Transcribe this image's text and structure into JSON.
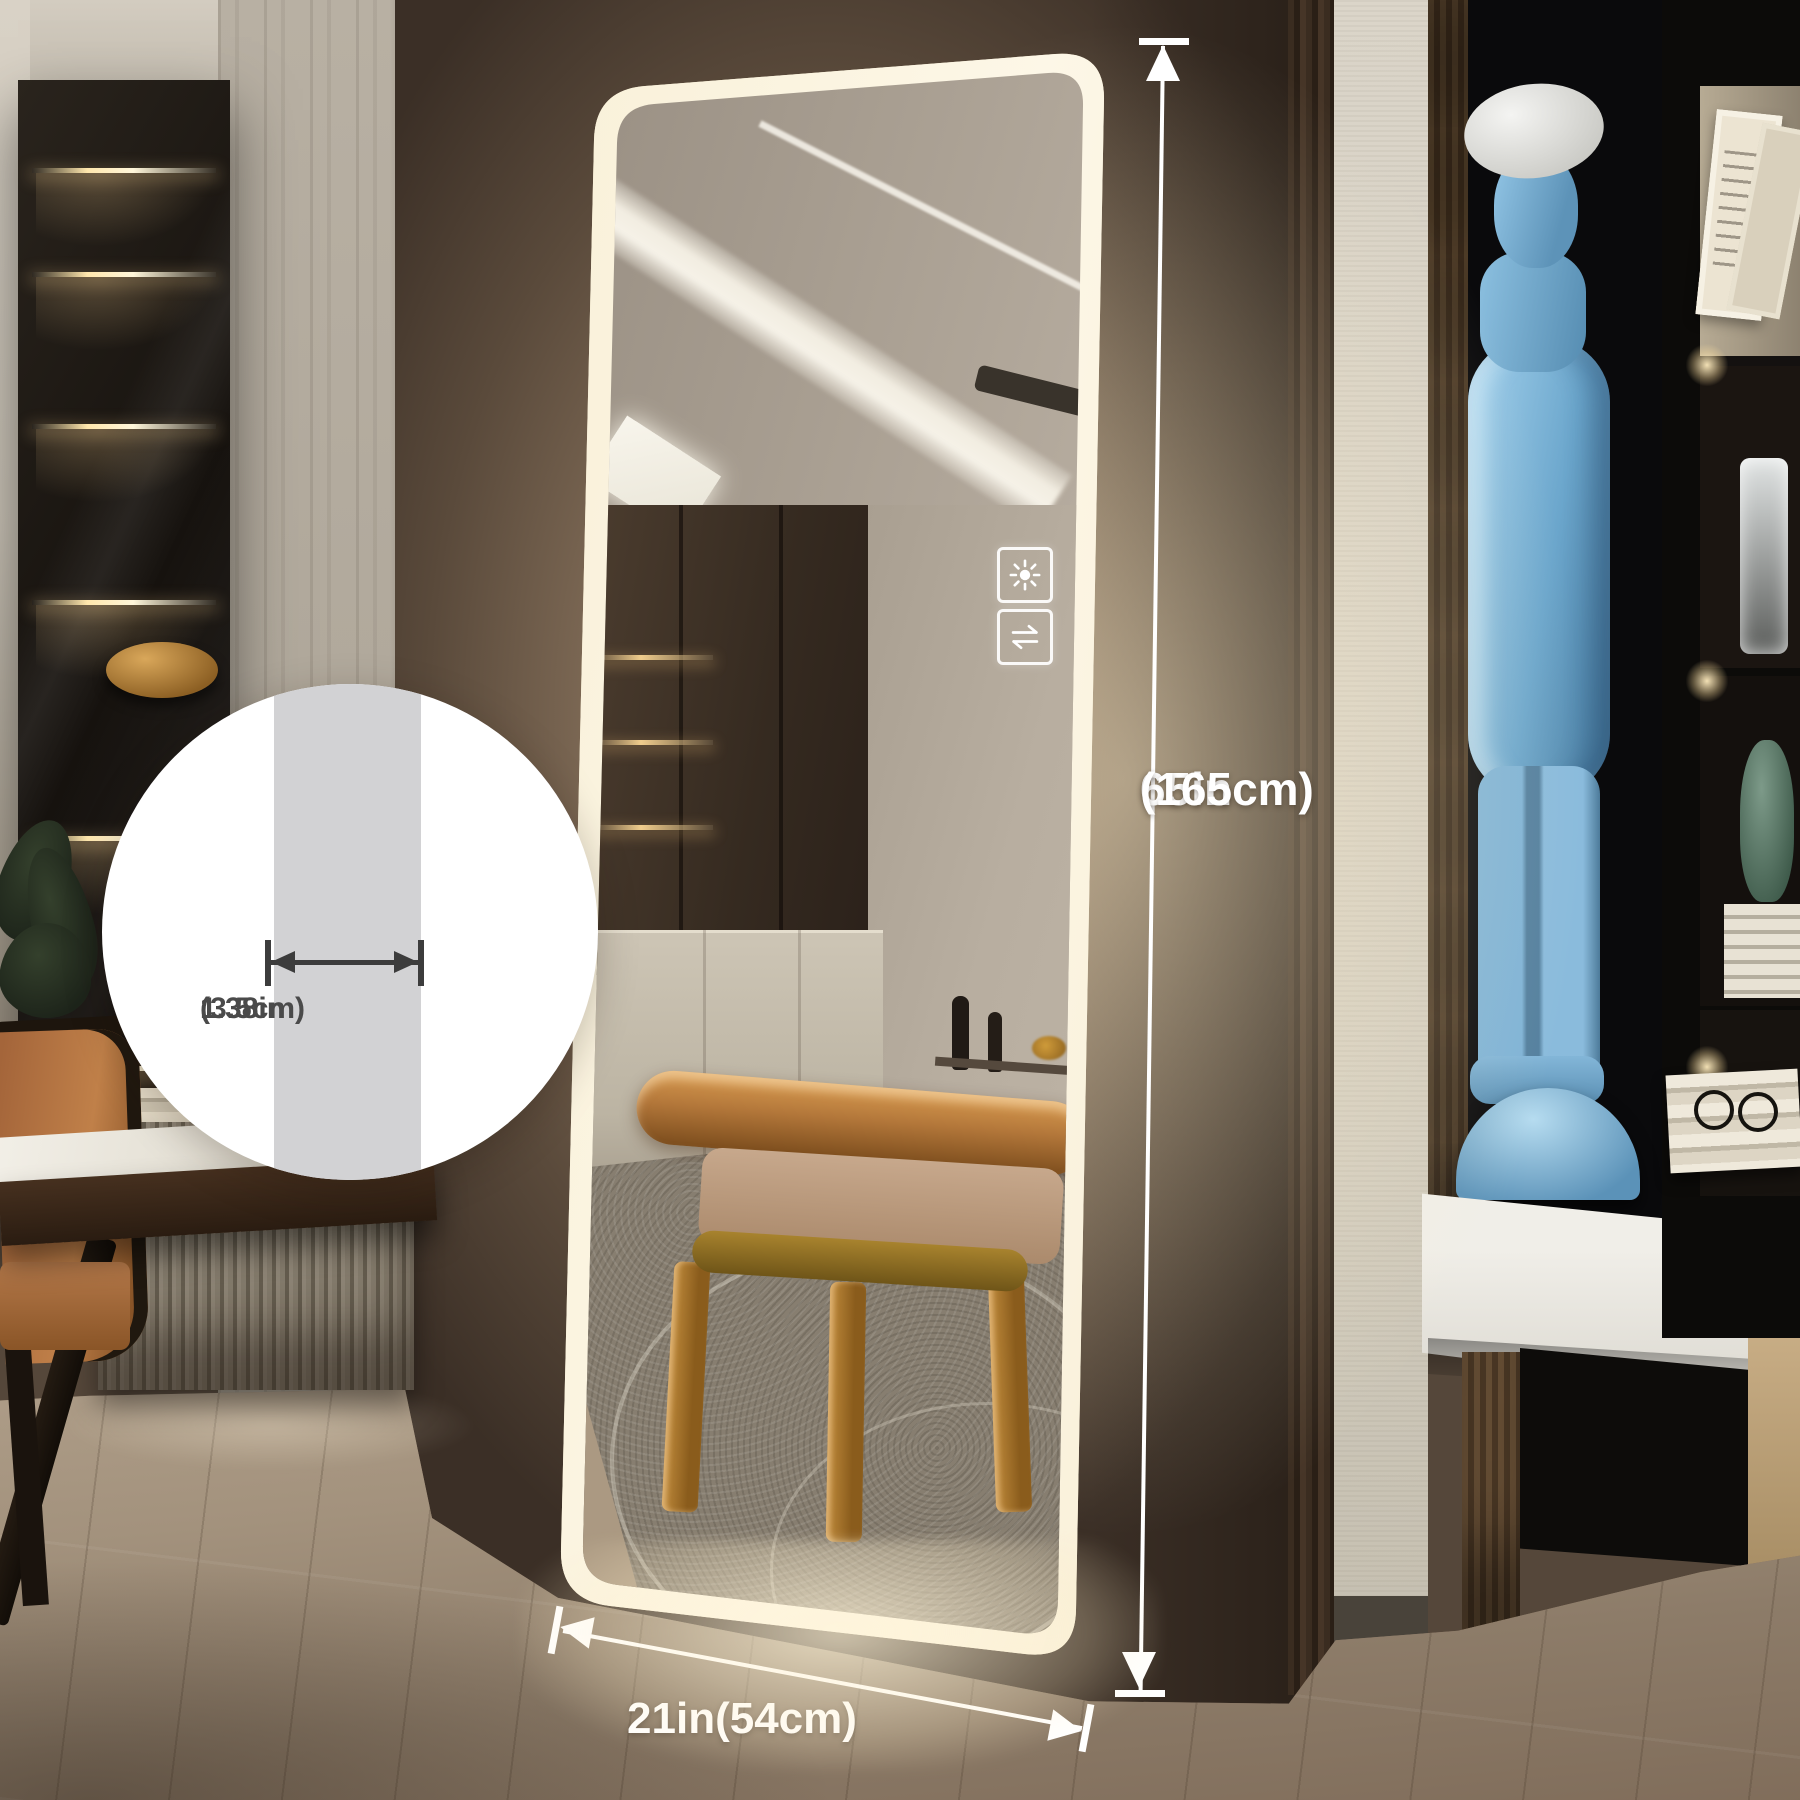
{
  "annotations": {
    "height_in": "65in",
    "height_cm": "(165cm)",
    "width_label": "21in(54cm)",
    "frame_width_in": "1.38in",
    "frame_width_cm": "(3.5cm)"
  },
  "icons": {
    "brightness": "sun-icon",
    "switch": "swap-arrows-icon"
  },
  "colors": {
    "led_glow": "#f8efd7",
    "dimension_line": "#ffffff",
    "inset_bar": "#d2d2d4",
    "inset_text": "#4a4a4a",
    "statue_blue": "#6fa9cf",
    "wall_brown": "#7c6854"
  }
}
